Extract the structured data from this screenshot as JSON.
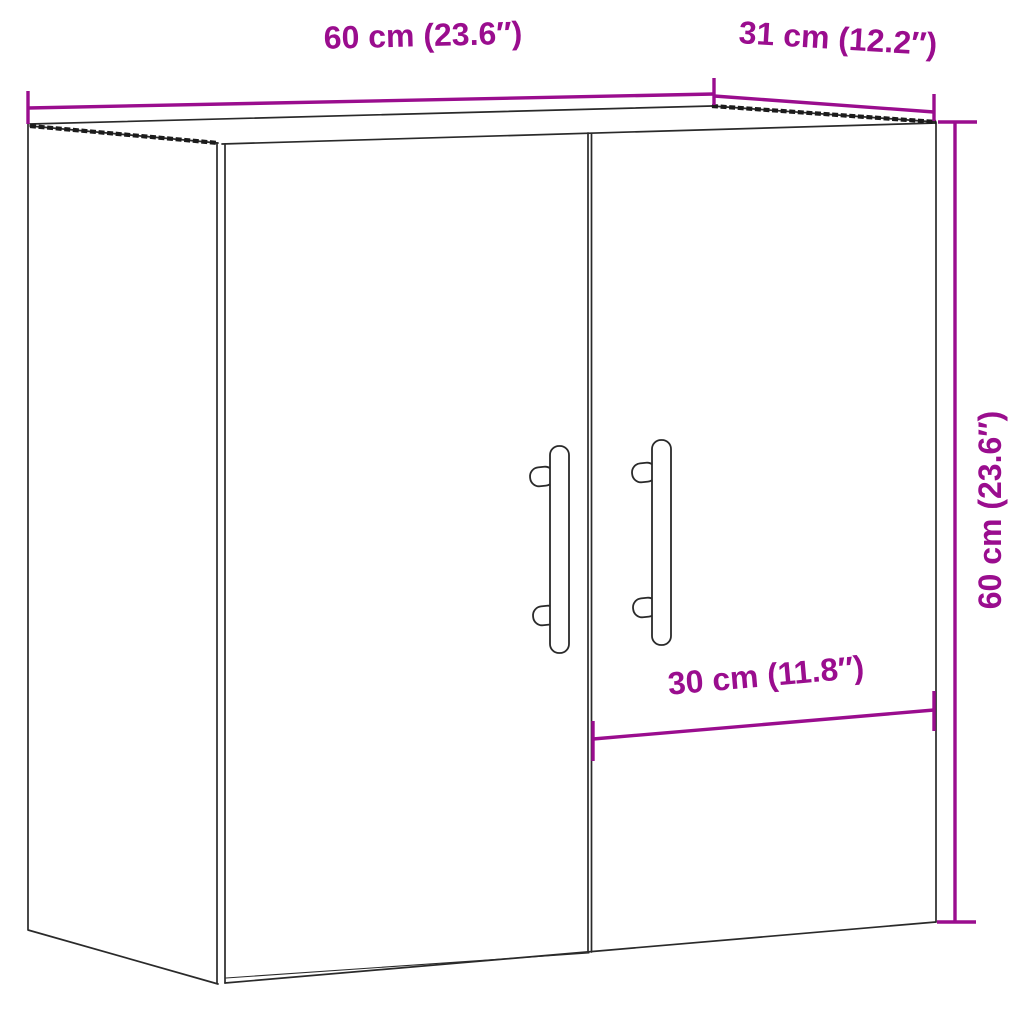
{
  "colors": {
    "dimension": "#9A0D8E",
    "outline": "#2A2A2A",
    "edge_hatch": "#1B1B1B",
    "background": "#FFFFFF",
    "handle_fill": "#FFFFFF"
  },
  "dimensions": {
    "width": {
      "label": "60 cm (23.6″)",
      "value_cm": 60,
      "value_in": 23.6
    },
    "depth": {
      "label": "31 cm (12.2″)",
      "value_cm": 31,
      "value_in": 12.2
    },
    "height": {
      "label": "60 cm (23.6″)",
      "value_cm": 60,
      "value_in": 23.6
    },
    "door_width": {
      "label": "30 cm (11.8″)",
      "value_cm": 30,
      "value_in": 11.8
    }
  }
}
